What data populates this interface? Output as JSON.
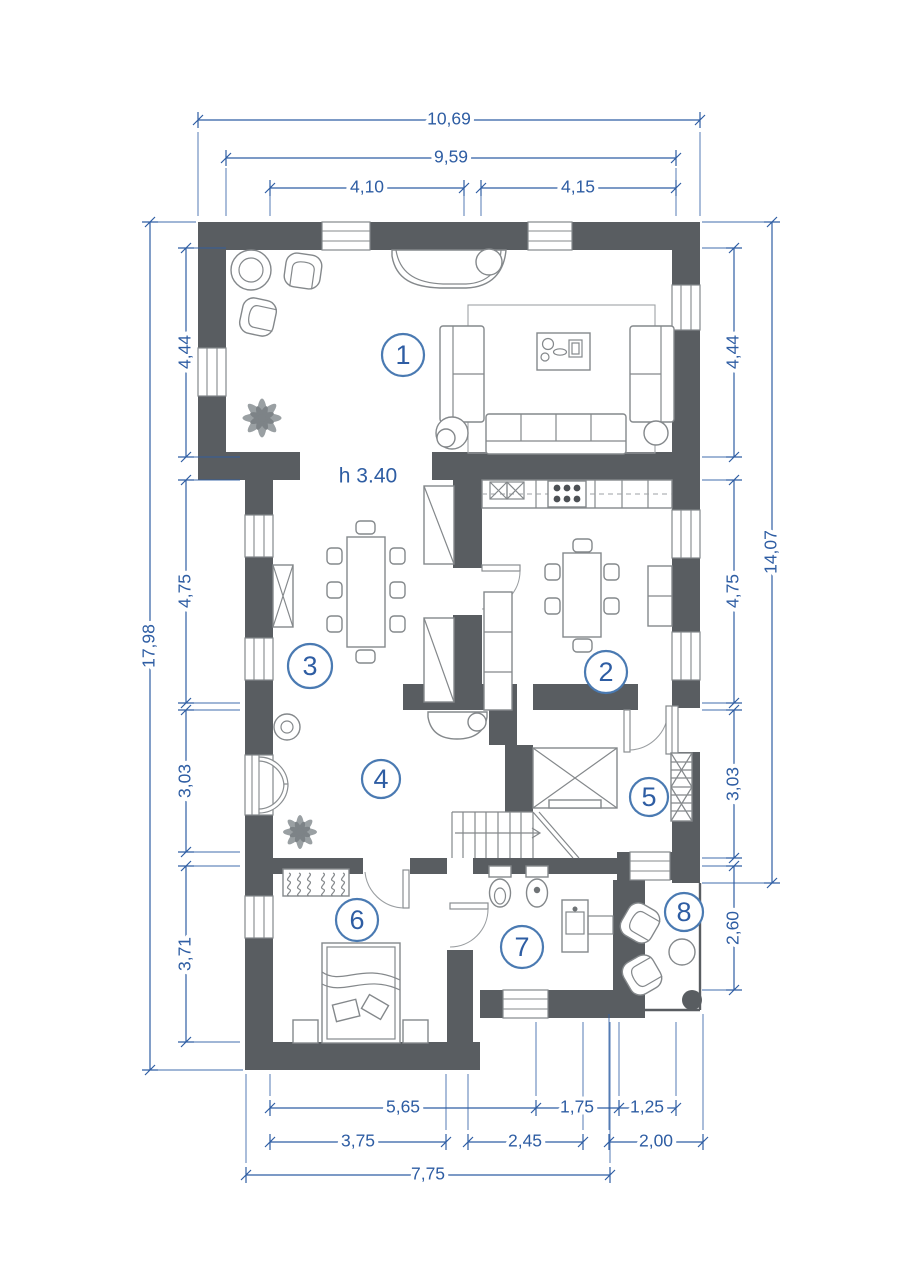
{
  "document": {
    "type": "architectural floor plan",
    "floor_height_note": "h 3.40"
  },
  "colors": {
    "wall": "#595d61",
    "dimension_blue": "#2e5da3",
    "room_circle_stroke": "#4a7ab2",
    "furniture_line": "#84888b"
  },
  "rooms": [
    {
      "number": "1"
    },
    {
      "number": "2"
    },
    {
      "number": "3"
    },
    {
      "number": "4"
    },
    {
      "number": "5"
    },
    {
      "number": "6"
    },
    {
      "number": "7"
    },
    {
      "number": "8"
    }
  ],
  "dimensions": {
    "top": [
      {
        "label": "10,69"
      },
      {
        "label": "9,59"
      },
      {
        "label": "4,10"
      },
      {
        "label": "4,15"
      }
    ],
    "left": [
      {
        "label": "4,44"
      },
      {
        "label": "4,75"
      },
      {
        "label": "3,03"
      },
      {
        "label": "3,71"
      },
      {
        "label": "17,98"
      }
    ],
    "right": [
      {
        "label": "4,44"
      },
      {
        "label": "4,75"
      },
      {
        "label": "3,03"
      },
      {
        "label": "2,60"
      },
      {
        "label": "14,07"
      }
    ],
    "bottom": [
      {
        "label": "5,65"
      },
      {
        "label": "1,75"
      },
      {
        "label": "1,25"
      },
      {
        "label": "3,75"
      },
      {
        "label": "2,45"
      },
      {
        "label": "2,00"
      },
      {
        "label": "7,75"
      }
    ]
  }
}
